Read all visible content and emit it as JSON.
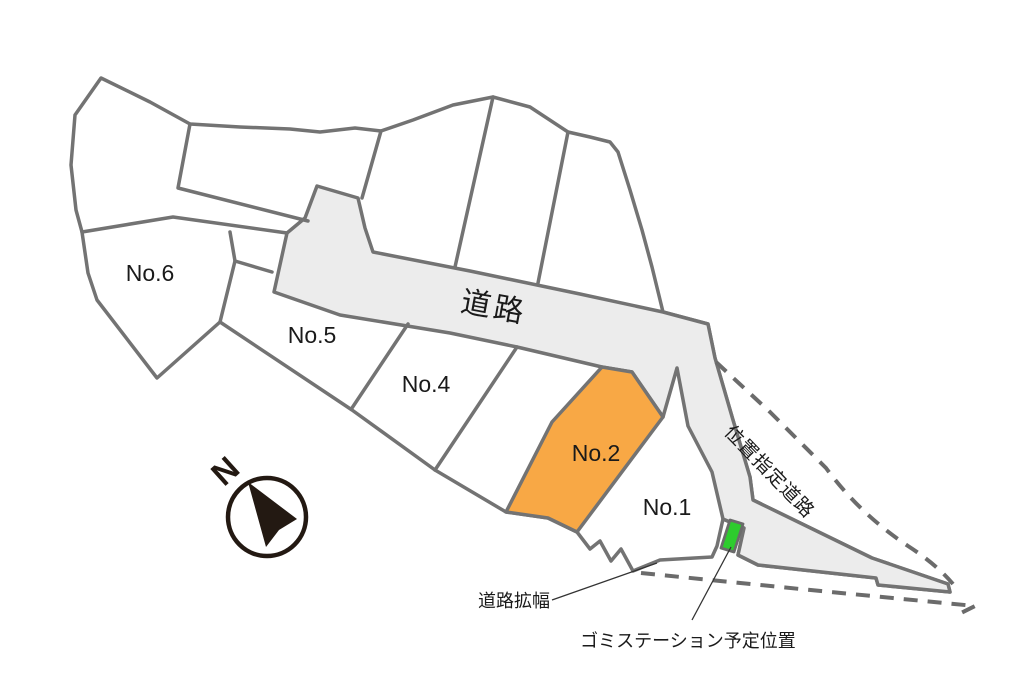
{
  "site_plan": {
    "plots": {
      "no1": "No.1",
      "no2": "No.2",
      "no4": "No.4",
      "no5": "No.5",
      "no6": "No.6"
    },
    "labels": {
      "main_road": "道路",
      "designated_road": "位置指定道路",
      "road_widening": "道路拡幅",
      "garbage_station": "ゴミステーション予定位置",
      "north": "N"
    },
    "colors": {
      "boundary": "#737373",
      "road_fill": "#ECECEC",
      "highlight_plot_fill": "#F8A845",
      "garbage_marker_fill": "#2ECC2E",
      "text": "#1A1A1A"
    }
  }
}
